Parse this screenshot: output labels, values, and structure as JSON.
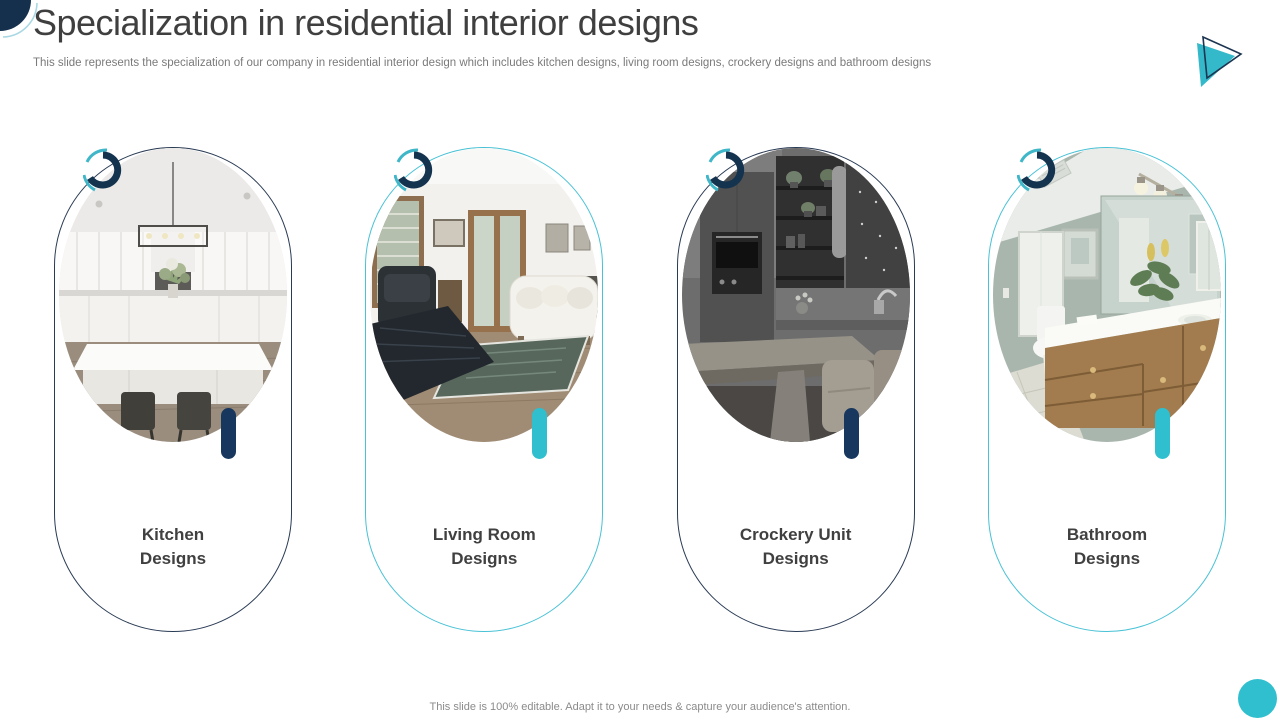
{
  "title": "Specialization in residential interior designs",
  "subtitle": "This slide represents the specialization of our company in residential interior design which includes kitchen designs, living room designs, crockery designs and bathroom designs",
  "footer": "This slide is 100% editable. Adapt it to your needs & capture your audience's attention.",
  "colors": {
    "navy": "#17375e",
    "teal": "#2fbfce",
    "title_text": "#3f3f3f",
    "body_text": "#7a7a7a",
    "label_text": "#404040"
  },
  "icons": {
    "top_left": "quarter-circle-corner-icon",
    "top_right": "play-triangle-icon",
    "card_badge": "swirl-arcs-icon",
    "bottom_right": "teal-dot"
  },
  "cards": [
    {
      "label_line1": "Kitchen",
      "label_line2": "Designs",
      "accent": "navy",
      "image": "white-kitchen-photo"
    },
    {
      "label_line1": "Living Room",
      "label_line2": "Designs",
      "accent": "teal",
      "image": "living-room-photo"
    },
    {
      "label_line1": "Crockery Unit",
      "label_line2": "Designs",
      "accent": "navy",
      "image": "crockery-unit-photo"
    },
    {
      "label_line1": "Bathroom",
      "label_line2": "Designs",
      "accent": "teal",
      "image": "bathroom-photo"
    }
  ]
}
